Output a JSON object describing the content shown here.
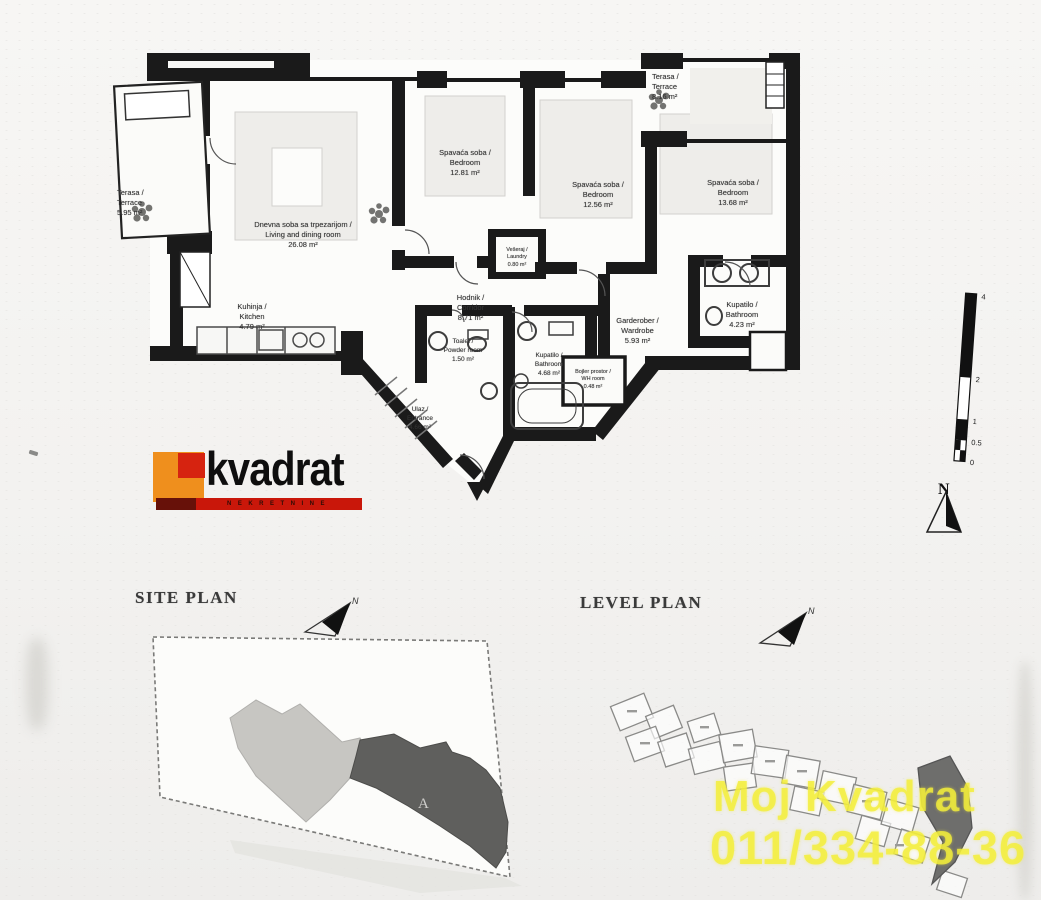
{
  "plan": {
    "rooms": [
      {
        "label": "Terasa /\nTerrace",
        "area": "5.95 m²"
      },
      {
        "label": "Dnevna soba sa trpezarijom /\nLiving and dining room",
        "area": "26.08 m²"
      },
      {
        "label": "Kuhinja /\nKitchen",
        "area": "4.79 m²"
      },
      {
        "label": "Spavaća soba /\nBedroom",
        "area": "12.81 m²"
      },
      {
        "label": "Spavaća soba /\nBedroom",
        "area": "12.56 m²"
      },
      {
        "label": "Spavaća soba /\nBedroom",
        "area": "13.68 m²"
      },
      {
        "label": "Terasa /\nTerrace",
        "area": "8.16 m²"
      },
      {
        "label": "Vešeraj /\nLaundry",
        "area": "0.80 m²"
      },
      {
        "label": "Hodnik /\nCorridor",
        "area": "8.71 m²"
      },
      {
        "label": "Toalet /\nPowder room",
        "area": "1.50 m²"
      },
      {
        "label": "Kupatilo /\nBathroom",
        "area": "4.68 m²"
      },
      {
        "label": "Garderober /\nWardrobe",
        "area": "5.93 m²"
      },
      {
        "label": "Kupatilo /\nBathroom",
        "area": "4.23 m²"
      },
      {
        "label": "Bojler prostor /\nWH room",
        "area": "0.48 m²"
      },
      {
        "label": "Ulaz /\nEntrance",
        "area": "4.66 m²"
      }
    ]
  },
  "logo": {
    "name": "kvadrat",
    "tagline": "NEKRETNINE"
  },
  "scale_bar": {
    "labels": [
      "4",
      "2",
      "1",
      "0.5",
      "0"
    ]
  },
  "north_arrow": {
    "label": "N"
  },
  "site_plan": {
    "title": "SITE PLAN",
    "north_label": "N",
    "block_label": "A"
  },
  "level_plan": {
    "title": "LEVEL PLAN",
    "north_label": "N"
  },
  "watermark": {
    "line1": "Moj Kvadrat",
    "line2": "011/334-88-36"
  },
  "colors": {
    "watermark_yellow": "#f3ee3a",
    "logo_orange": "#ef8f1d",
    "logo_red": "#d62310",
    "logo_bar_red": "#c9170a",
    "wall_black": "#1a1a1a",
    "site_footprint_light": "#c7c6c2",
    "site_footprint_dark": "#5f5f5d"
  }
}
